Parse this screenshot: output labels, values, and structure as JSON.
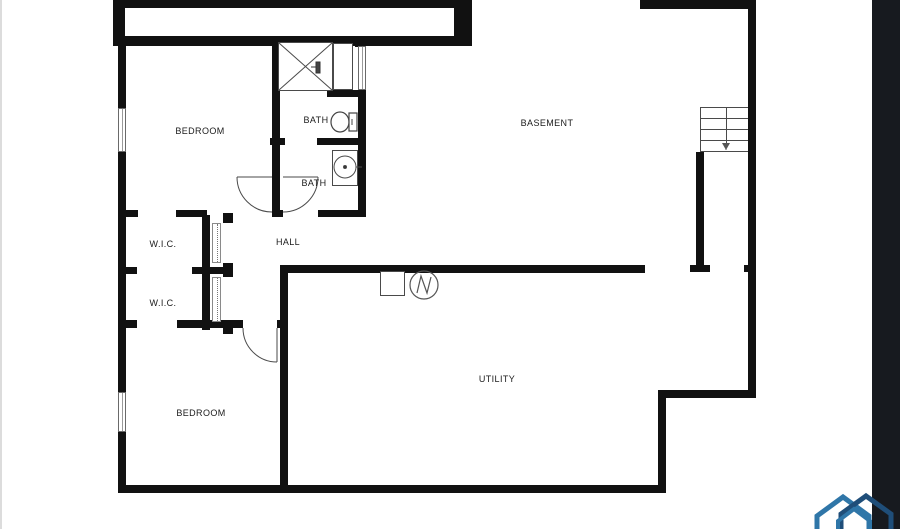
{
  "plan": {
    "rooms": {
      "bedroom_upper": "BEDROOM",
      "bath_upper": "BATH",
      "bath_lower": "BATH",
      "basement": "BASEMENT",
      "hall": "HALL",
      "wic_upper": "W.I.C.",
      "wic_lower": "W.I.C.",
      "bedroom_lower": "BEDROOM",
      "utility": "UTILITY"
    },
    "fixtures": [
      "shower",
      "linen-closet",
      "toilet",
      "sink-vanity",
      "furnace",
      "water-heater",
      "stairs-down",
      "window",
      "door-swing",
      "sliding-door"
    ],
    "colors": {
      "wall": "#111111",
      "thin_line": "#4a4a4a",
      "text": "#1b1b1b",
      "right_band": "#171a1f",
      "left_edge": "#dcdcdc",
      "logo_light": "#2f76a8",
      "logo_dark": "#1f4e79"
    }
  }
}
